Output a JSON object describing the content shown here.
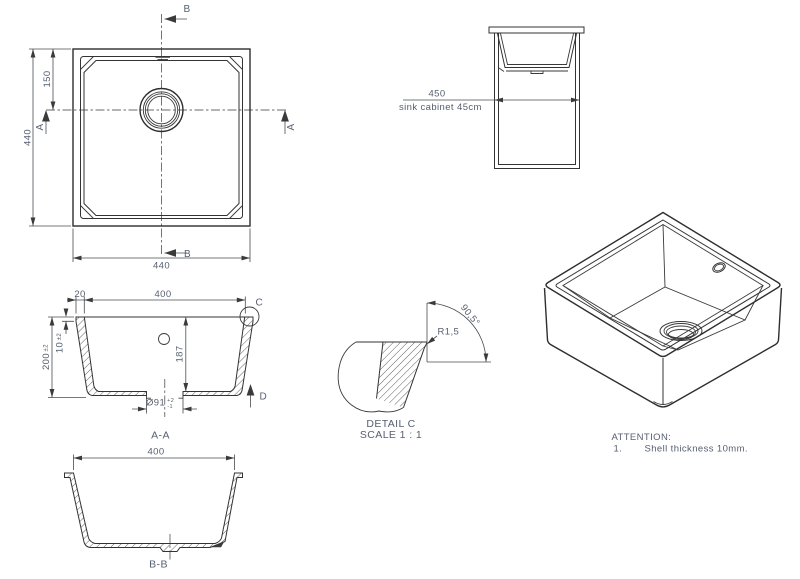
{
  "plan_view": {
    "section_b": "B",
    "section_a": "A",
    "dim_overall_height": "440",
    "dim_overall_width": "440",
    "dim_drain_from_top": "150"
  },
  "cabinet_view": {
    "dim_width": "450",
    "cabinet_label": "sink cabinet 45cm"
  },
  "section_a_a": {
    "title": "A-A",
    "dim_rim_width": "20",
    "dim_inner_width": "400",
    "dim_height": "200",
    "dim_height_tol": "±2",
    "dim_shell": "10",
    "dim_shell_tol": "±2",
    "dim_depth": "187",
    "dim_drain_dia": "Ø91",
    "dim_drain_tol_plus": "+2",
    "dim_drain_tol_minus": "-1",
    "detail_label": "C",
    "view_label": "D"
  },
  "detail_c": {
    "title": "DETAIL C",
    "scale": "SCALE 1 : 1",
    "dim_radius": "R1,5",
    "dim_angle": "90,5°"
  },
  "section_b_b": {
    "title": "B-B",
    "dim_inner_width": "400"
  },
  "attention": {
    "title": "ATTENTION:",
    "note_number": "1.",
    "note_text": "Shell thickness 10mm."
  },
  "colors": {
    "line": "#333333",
    "dim_text": "#566070",
    "background": "#ffffff"
  }
}
